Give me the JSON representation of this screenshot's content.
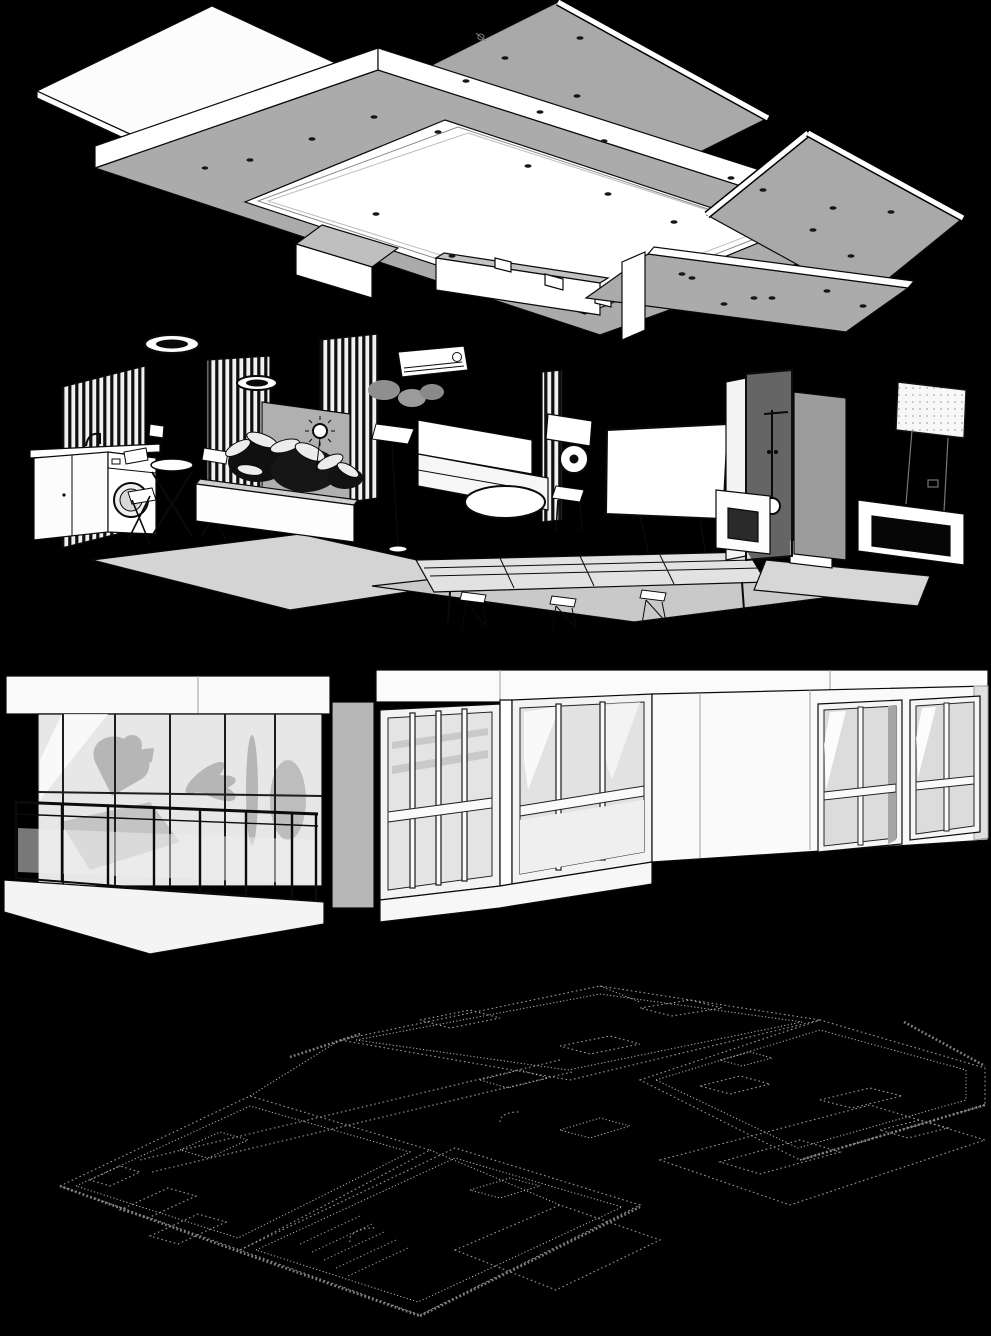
{
  "document": {
    "background": "#000000",
    "kind_label": "exploded-axonometric-architecture-drawing"
  },
  "palette": {
    "background": "#000000",
    "panel_gray": "#a9a9a9",
    "panel_white": "#fbfbfb",
    "line_black": "#0a0a0a",
    "glass_gray": "#e6e6e6",
    "shadow_gray": "#b6b6b6",
    "plan_dot_gray": "#9a9a9a"
  },
  "layers": [
    {
      "id": "ceiling-assembly",
      "label": "Ceiling panel assembly with recessed light cove and downlight fittings"
    },
    {
      "id": "interior-furnishings",
      "label": "Interior furnishing layer: louver screens, washing machine, bistro set, planters, sofa, projection screen, shower and desk"
    },
    {
      "id": "building-envelope",
      "label": "Building envelope layer: balcony railing, glazed corner sunroom and punched windows"
    },
    {
      "id": "floor-plan-ghost",
      "label": "Dotted ghost floor plan underlay"
    }
  ]
}
